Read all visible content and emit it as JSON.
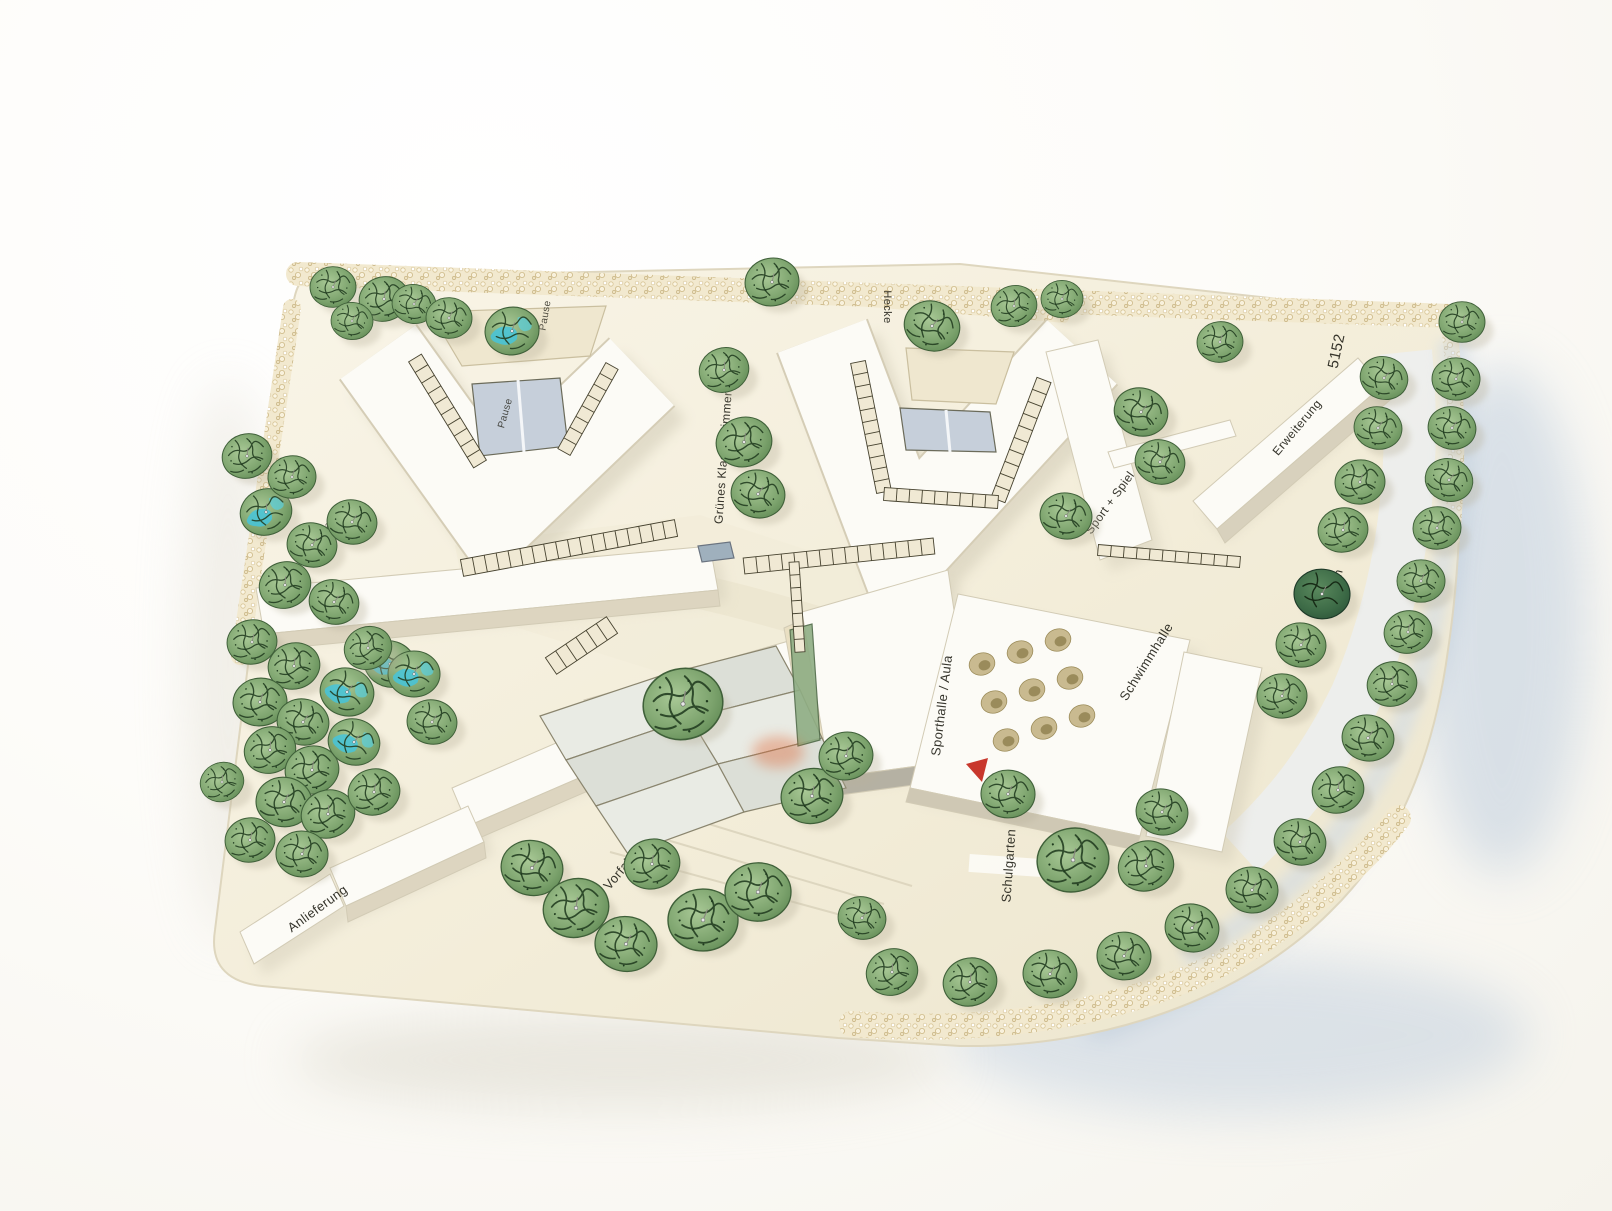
{
  "scene": {
    "labels": [
      {
        "id": "hecke",
        "text": "Hecke"
      },
      {
        "id": "entry-number",
        "text": "5152"
      },
      {
        "id": "erweiterung",
        "text": "Erweiterung"
      },
      {
        "id": "sport-spiel",
        "text": "Sport + Spiel"
      },
      {
        "id": "parken",
        "text": "Parken"
      },
      {
        "id": "gruenes-klassenzimmer",
        "text": "Grünes Klassenzimmer"
      },
      {
        "id": "sporthalle-aula",
        "text": "Sporthalle / Aula"
      },
      {
        "id": "schwimmhalle",
        "text": "Schwimmhalle"
      },
      {
        "id": "schulgarten",
        "text": "Schulgarten"
      },
      {
        "id": "vorfahrt",
        "text": "Vorfahrt"
      },
      {
        "id": "anlieferung",
        "text": "Anlieferung"
      },
      {
        "id": "pause-north",
        "text": "Pause"
      },
      {
        "id": "pause-courtyard",
        "text": "Pause"
      },
      {
        "id": "pause-west",
        "text": "Pause"
      }
    ],
    "colors": {
      "base_plate": "#f4efdc",
      "building_white": "#fcfbf6",
      "building_edge": "#d2cbb5",
      "glass_blue": "#c6cfda",
      "tree_green": "#7ba26c",
      "tree_teal": "#45c4da",
      "tree_dark_green": "#3c6a46",
      "hedge_foam": "#f2e9cf",
      "marker_red": "#c8372c",
      "shadow_blue": "#b9c9db"
    },
    "trees": [
      {
        "x": 333,
        "y": 287,
        "r": 23,
        "v": "g"
      },
      {
        "x": 384,
        "y": 299,
        "r": 25,
        "v": "g"
      },
      {
        "x": 352,
        "y": 321,
        "r": 21,
        "v": "g"
      },
      {
        "x": 414,
        "y": 304,
        "r": 22,
        "v": "g"
      },
      {
        "x": 449,
        "y": 318,
        "r": 23,
        "v": "g"
      },
      {
        "x": 512,
        "y": 331,
        "r": 27,
        "v": "t"
      },
      {
        "x": 772,
        "y": 282,
        "r": 27,
        "v": "g"
      },
      {
        "x": 932,
        "y": 326,
        "r": 28,
        "v": "g"
      },
      {
        "x": 1014,
        "y": 306,
        "r": 23,
        "v": "g"
      },
      {
        "x": 1062,
        "y": 299,
        "r": 21,
        "v": "g"
      },
      {
        "x": 1220,
        "y": 342,
        "r": 23,
        "v": "g"
      },
      {
        "x": 247,
        "y": 456,
        "r": 25,
        "v": "g"
      },
      {
        "x": 266,
        "y": 512,
        "r": 26,
        "v": "t"
      },
      {
        "x": 292,
        "y": 477,
        "r": 24,
        "v": "g"
      },
      {
        "x": 312,
        "y": 545,
        "r": 25,
        "v": "g"
      },
      {
        "x": 352,
        "y": 522,
        "r": 25,
        "v": "g"
      },
      {
        "x": 285,
        "y": 585,
        "r": 26,
        "v": "g"
      },
      {
        "x": 334,
        "y": 602,
        "r": 25,
        "v": "g"
      },
      {
        "x": 724,
        "y": 370,
        "r": 25,
        "v": "g"
      },
      {
        "x": 744,
        "y": 442,
        "r": 28,
        "v": "g"
      },
      {
        "x": 758,
        "y": 494,
        "r": 27,
        "v": "g"
      },
      {
        "x": 1066,
        "y": 516,
        "r": 26,
        "v": "g"
      },
      {
        "x": 1141,
        "y": 412,
        "r": 27,
        "v": "g"
      },
      {
        "x": 1160,
        "y": 462,
        "r": 25,
        "v": "g"
      },
      {
        "x": 1462,
        "y": 322,
        "r": 23,
        "v": "g"
      },
      {
        "x": 1456,
        "y": 379,
        "r": 24,
        "v": "g"
      },
      {
        "x": 1452,
        "y": 428,
        "r": 24,
        "v": "g"
      },
      {
        "x": 1449,
        "y": 480,
        "r": 24,
        "v": "g"
      },
      {
        "x": 1437,
        "y": 528,
        "r": 24,
        "v": "g"
      },
      {
        "x": 1421,
        "y": 581,
        "r": 24,
        "v": "g"
      },
      {
        "x": 1408,
        "y": 632,
        "r": 24,
        "v": "g"
      },
      {
        "x": 1392,
        "y": 684,
        "r": 25,
        "v": "g"
      },
      {
        "x": 1368,
        "y": 738,
        "r": 26,
        "v": "g"
      },
      {
        "x": 1338,
        "y": 790,
        "r": 26,
        "v": "g"
      },
      {
        "x": 1300,
        "y": 842,
        "r": 26,
        "v": "g"
      },
      {
        "x": 1252,
        "y": 890,
        "r": 26,
        "v": "g"
      },
      {
        "x": 1192,
        "y": 928,
        "r": 27,
        "v": "g"
      },
      {
        "x": 1124,
        "y": 956,
        "r": 27,
        "v": "g"
      },
      {
        "x": 1050,
        "y": 974,
        "r": 27,
        "v": "g"
      },
      {
        "x": 970,
        "y": 982,
        "r": 27,
        "v": "g"
      },
      {
        "x": 892,
        "y": 972,
        "r": 26,
        "v": "g"
      },
      {
        "x": 1384,
        "y": 378,
        "r": 24,
        "v": "g"
      },
      {
        "x": 1378,
        "y": 428,
        "r": 24,
        "v": "g"
      },
      {
        "x": 1360,
        "y": 482,
        "r": 25,
        "v": "g"
      },
      {
        "x": 1343,
        "y": 530,
        "r": 25,
        "v": "g"
      },
      {
        "x": 1322,
        "y": 594,
        "r": 28,
        "v": "d"
      },
      {
        "x": 1301,
        "y": 645,
        "r": 25,
        "v": "g"
      },
      {
        "x": 1282,
        "y": 696,
        "r": 25,
        "v": "g"
      },
      {
        "x": 252,
        "y": 642,
        "r": 25,
        "v": "g"
      },
      {
        "x": 294,
        "y": 666,
        "r": 26,
        "v": "g"
      },
      {
        "x": 260,
        "y": 702,
        "r": 27,
        "v": "g"
      },
      {
        "x": 303,
        "y": 722,
        "r": 26,
        "v": "g"
      },
      {
        "x": 347,
        "y": 692,
        "r": 27,
        "v": "t"
      },
      {
        "x": 390,
        "y": 664,
        "r": 26,
        "v": "t"
      },
      {
        "x": 270,
        "y": 750,
        "r": 26,
        "v": "g"
      },
      {
        "x": 312,
        "y": 770,
        "r": 27,
        "v": "g"
      },
      {
        "x": 354,
        "y": 742,
        "r": 26,
        "v": "t"
      },
      {
        "x": 284,
        "y": 802,
        "r": 28,
        "v": "g"
      },
      {
        "x": 328,
        "y": 814,
        "r": 27,
        "v": "g"
      },
      {
        "x": 374,
        "y": 792,
        "r": 26,
        "v": "g"
      },
      {
        "x": 250,
        "y": 840,
        "r": 25,
        "v": "g"
      },
      {
        "x": 302,
        "y": 854,
        "r": 26,
        "v": "g"
      },
      {
        "x": 222,
        "y": 782,
        "r": 22,
        "v": "g"
      },
      {
        "x": 414,
        "y": 674,
        "r": 26,
        "v": "t"
      },
      {
        "x": 432,
        "y": 722,
        "r": 25,
        "v": "g"
      },
      {
        "x": 368,
        "y": 648,
        "r": 24,
        "v": "g"
      },
      {
        "x": 532,
        "y": 868,
        "r": 31,
        "v": "g"
      },
      {
        "x": 576,
        "y": 908,
        "r": 33,
        "v": "g"
      },
      {
        "x": 626,
        "y": 944,
        "r": 31,
        "v": "g"
      },
      {
        "x": 703,
        "y": 920,
        "r": 35,
        "v": "g"
      },
      {
        "x": 758,
        "y": 892,
        "r": 33,
        "v": "g"
      },
      {
        "x": 812,
        "y": 796,
        "r": 31,
        "v": "g"
      },
      {
        "x": 652,
        "y": 864,
        "r": 28,
        "v": "g"
      },
      {
        "x": 846,
        "y": 756,
        "r": 27,
        "v": "g"
      },
      {
        "x": 683,
        "y": 704,
        "r": 40,
        "v": "g"
      },
      {
        "x": 1008,
        "y": 794,
        "r": 27,
        "v": "g"
      },
      {
        "x": 1073,
        "y": 860,
        "r": 36,
        "v": "g"
      },
      {
        "x": 1146,
        "y": 866,
        "r": 28,
        "v": "g"
      },
      {
        "x": 1162,
        "y": 812,
        "r": 26,
        "v": "g"
      },
      {
        "x": 862,
        "y": 918,
        "r": 24,
        "v": "g"
      }
    ]
  }
}
